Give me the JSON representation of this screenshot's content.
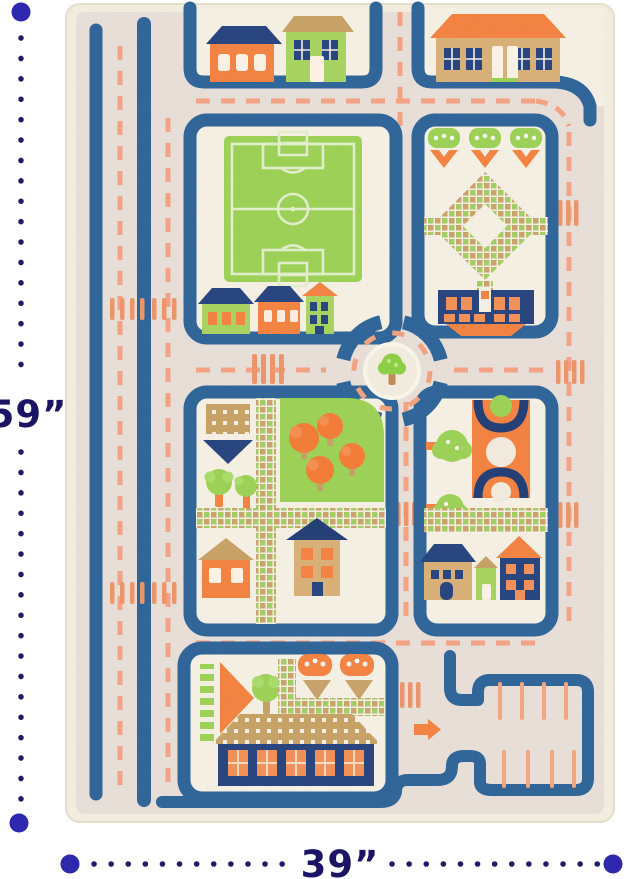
{
  "annotation": {
    "height_label": "59”",
    "width_label": "39”"
  },
  "palette": {
    "annotation_navy": "#1b1464",
    "dot_blue": "#2d28ad",
    "road_blue": "#2c6399",
    "roof_navy": "#24427e",
    "rug_cream": "#f7f2e5",
    "road_surface": "#e9e0d9",
    "fringe": "#f4efe1",
    "accent_orange": "#f5823f",
    "dash_salmon": "#f7a283",
    "crosswalk_orange": "#ef9468",
    "grass_green": "#9cd254",
    "house_green": "#a8d45f",
    "tan": "#c8a264"
  },
  "rug": {
    "type": "kids 3D traffic play rug",
    "features": [
      "two-lane roads with dashed lane markings",
      "soccer field",
      "roundabout with center tree island",
      "parking lot with stalls and entry arrow",
      "houses with orange, green and navy facades",
      "park with orange and green trees",
      "checkered garden paths",
      "pedestrian crosswalks"
    ]
  }
}
